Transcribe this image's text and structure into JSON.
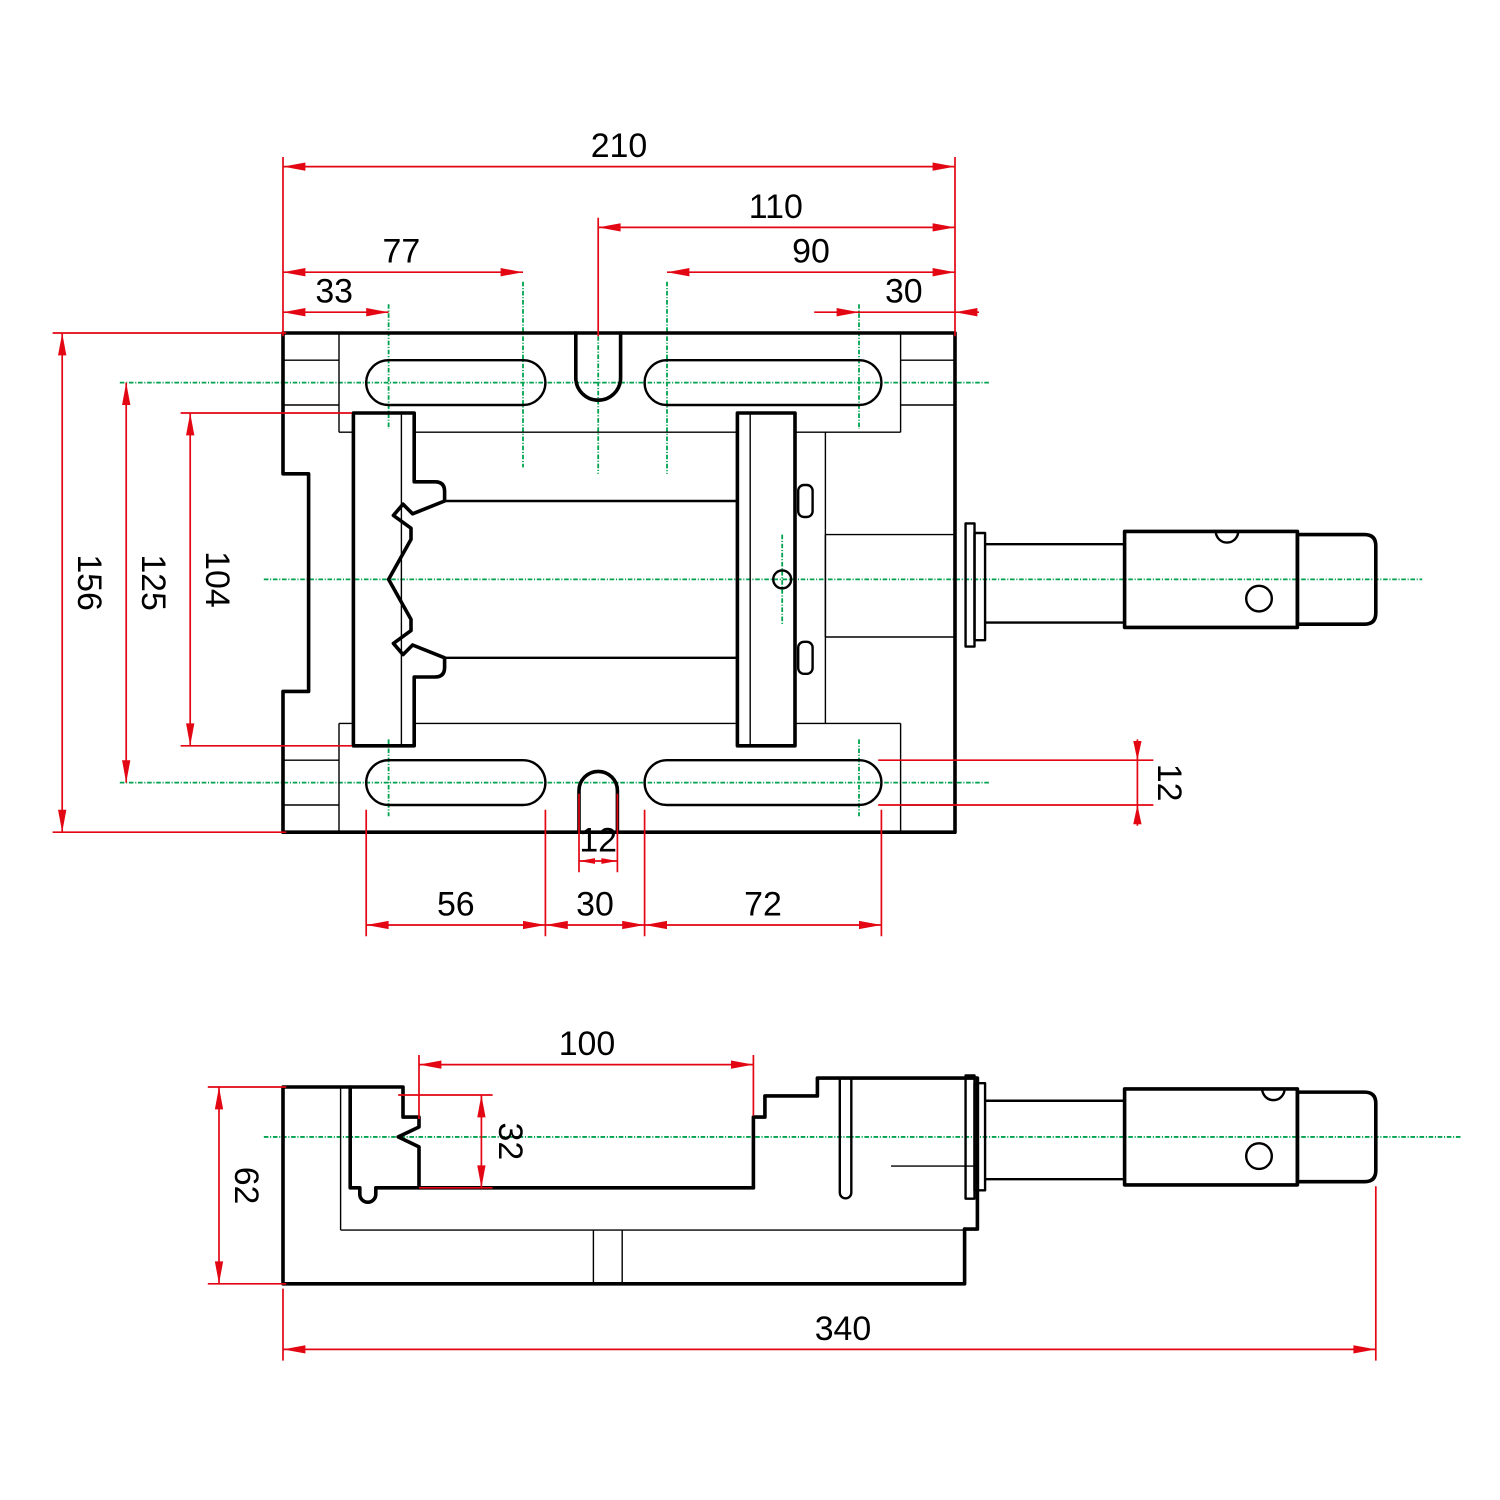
{
  "drawing": {
    "title": "machine-vise two-view dimensioned technical drawing",
    "units": "mm",
    "colors": {
      "object_lines": "#000000",
      "dimension_lines": "#e30613",
      "center_lines": "#00a24f",
      "background": "#ffffff"
    },
    "top_view": {
      "name": "top view",
      "dims": {
        "total_width": "210",
        "center_to_right": "110",
        "left_slot_far": "77",
        "left_slot_near": "33",
        "right_edge_offset": "30",
        "right_slot_span": "90",
        "total_depth": "156",
        "slot_centerline_spacing": "125",
        "jaw_plate_length": "104",
        "slot_height": "12",
        "notch_width": "12",
        "lower_left_slot": "56",
        "lower_gap": "30",
        "lower_right_slot": "72"
      }
    },
    "side_view": {
      "name": "side view",
      "dims": {
        "jaw_opening": "100",
        "jaw_height": "32",
        "body_height": "62",
        "total_length": "340"
      }
    }
  }
}
